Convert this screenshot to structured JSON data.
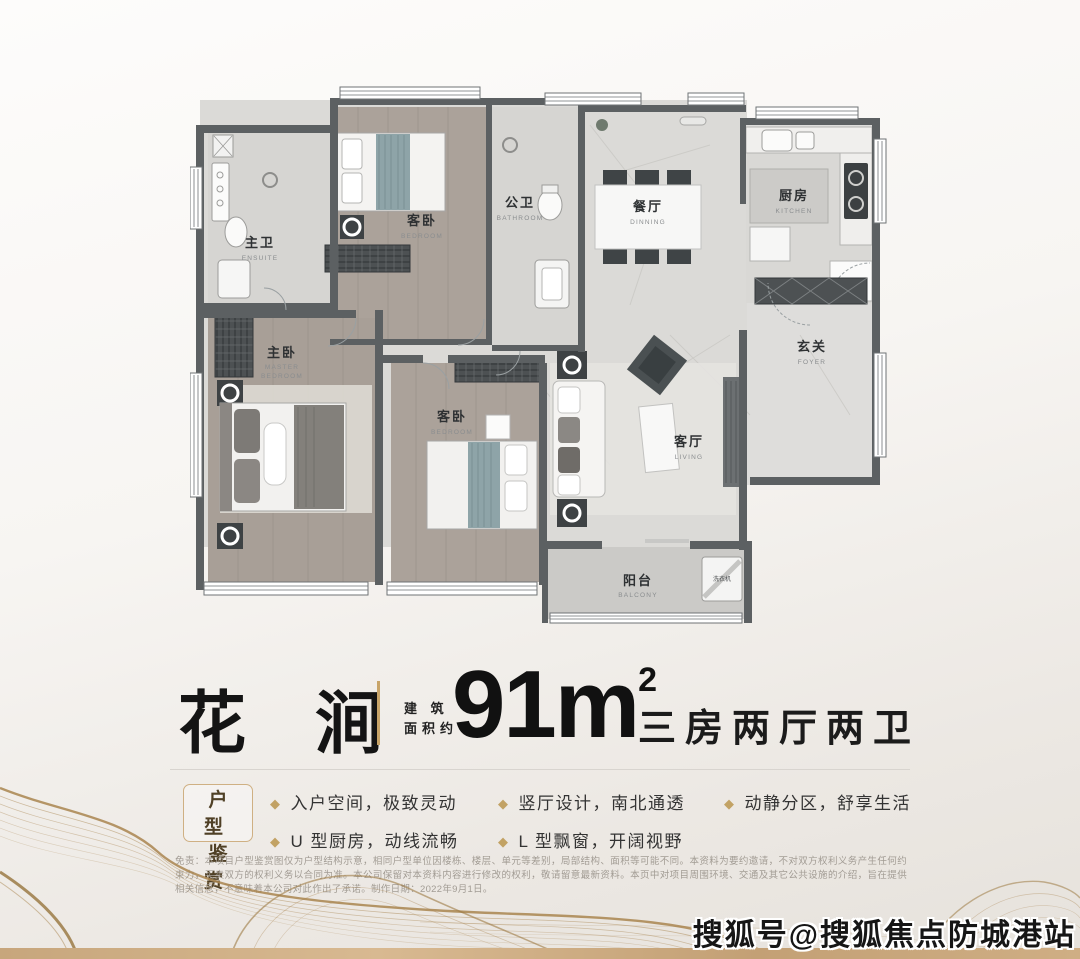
{
  "title": {
    "name": "花 涧",
    "area_prefix_line1": "建 筑",
    "area_prefix_line2": "面积约",
    "area_value": "91m",
    "area_sup": "2",
    "layout_desc": "三房两厅两卫"
  },
  "features": {
    "badge_line1": "户 型",
    "badge_line2": "鉴 赏",
    "bullet_icon": "◆",
    "items": [
      "入户空间，极致灵动",
      "U 型厨房，动线流畅",
      "竖厅设计，南北通透",
      "L 型飘窗，开阔视野",
      "动静分区，舒享生活"
    ]
  },
  "disclaimer": "免责：本项目户型鉴赏图仅为户型结构示意，相同户型单位因楼栋、楼层、单元等差别，局部结构、面积等可能不同。本资料为要约邀请，不对双方权利义务产生任何约束力，买卖双方的权利义务以合同为准。本公司保留对本资料内容进行修改的权利，敬请留意最新资料。本页中对项目周围环境、交通及其它公共设施的介绍，旨在提供相关信息，不意味着本公司对此作出了承诺。制作日期：2022年9月1日。",
  "watermark": "搜狐号@搜狐焦点防城港站",
  "plan": {
    "rooms": [
      {
        "cn": "主卫",
        "en": "ENSUITE"
      },
      {
        "cn": "客卧",
        "en": "BEDROOM"
      },
      {
        "cn": "公卫",
        "en": "BATHROOM"
      },
      {
        "cn": "餐厅",
        "en": "DINNING"
      },
      {
        "cn": "厨房",
        "en": "KITCHEN"
      },
      {
        "cn": "玄关",
        "en": "FOYER"
      },
      {
        "cn": "主卧",
        "en1": "MASTER",
        "en2": "BEDROOM"
      },
      {
        "cn": "客卧",
        "en": "BEDROOM"
      },
      {
        "cn": "客厅",
        "en": "LIVING"
      },
      {
        "cn": "阳台",
        "en": "BALCONY"
      }
    ],
    "washer_label": "洗衣机"
  },
  "colors": {
    "accent_gold": "#c8a468",
    "wall": "#5c6062",
    "wood_floor": "#aba29a",
    "marble_floor": "#dbdad7",
    "balcony_floor": "#cbcac7",
    "bronze_strip": "#c9a77c",
    "blanket_teal": "#8ea4a8",
    "wave_gold": "#a9854f"
  }
}
